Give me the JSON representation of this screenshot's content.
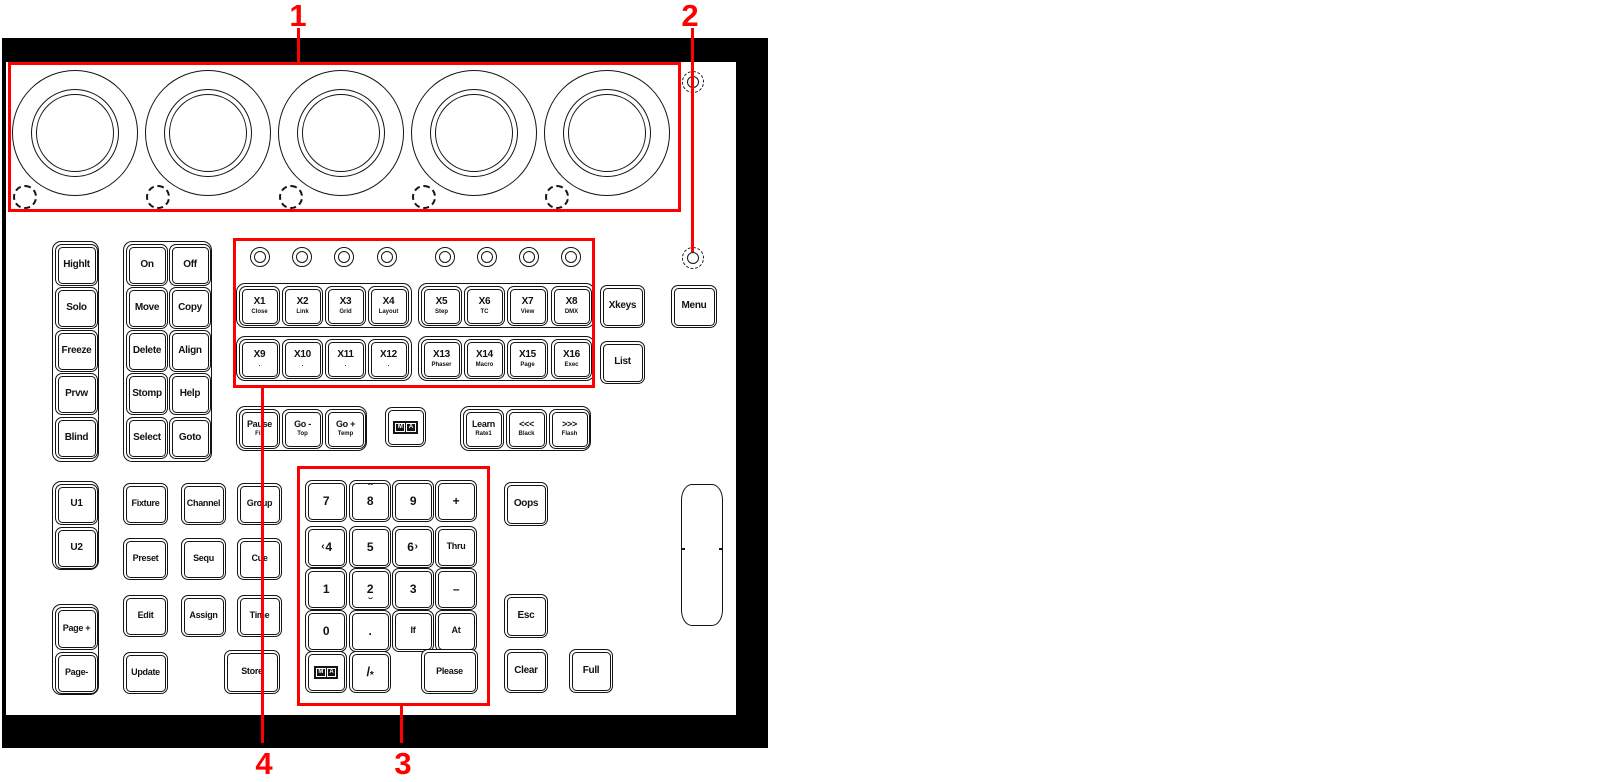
{
  "annotations": {
    "n1": "1",
    "n2": "2",
    "n3": "3",
    "n4": "4"
  },
  "colors": {
    "annotation_red": "#ff0000",
    "line_art": "#141414",
    "frame": "#000000"
  },
  "left_strip": [
    "Highlt",
    "Solo",
    "Freeze",
    "Prvw",
    "Blind"
  ],
  "action": [
    "On",
    "Off",
    "Move",
    "Copy",
    "Delete",
    "Align",
    "Stomp",
    "Help",
    "Select",
    "Goto"
  ],
  "user": {
    "u1": "U1",
    "u2": "U2",
    "page_up": "Page +",
    "page_down": "Page-"
  },
  "grid": {
    "fixture": "Fixture",
    "channel": "Channel",
    "group": "Group",
    "preset": "Preset",
    "sequ": "Sequ",
    "cue": "Cue",
    "edit": "Edit",
    "assign": "Assign",
    "time": "Time",
    "update": "Update",
    "store": "Store"
  },
  "command": {
    "xkeys": "Xkeys",
    "list": "List",
    "menu": "Menu",
    "oops": "Oops",
    "esc": "Esc",
    "clear": "Clear",
    "full": "Full"
  },
  "xkeys": {
    "x1": {
      "m": "X1",
      "s": "Close"
    },
    "x2": {
      "m": "X2",
      "s": "Link"
    },
    "x3": {
      "m": "X3",
      "s": "Grid"
    },
    "x4": {
      "m": "X4",
      "s": "Layout"
    },
    "x5": {
      "m": "X5",
      "s": "Step"
    },
    "x6": {
      "m": "X6",
      "s": "TC"
    },
    "x7": {
      "m": "X7",
      "s": "View"
    },
    "x8": {
      "m": "X8",
      "s": "DMX"
    },
    "x9": {
      "m": "X9",
      "s": "."
    },
    "x10": {
      "m": "X10",
      "s": "."
    },
    "x11": {
      "m": "X11",
      "s": "."
    },
    "x12": {
      "m": "X12",
      "s": "."
    },
    "x13": {
      "m": "X13",
      "s": "Phaser"
    },
    "x14": {
      "m": "X14",
      "s": "Macro"
    },
    "x15": {
      "m": "X15",
      "s": "Page"
    },
    "x16": {
      "m": "X16",
      "s": "Exec"
    }
  },
  "playback": {
    "pause": {
      "m": "Pause",
      "s": "Fix"
    },
    "go_minus": {
      "m": "Go -",
      "s": "Top"
    },
    "go_plus": {
      "m": "Go +",
      "s": "Temp"
    },
    "learn": {
      "m": "Learn",
      "s": "Rate1"
    },
    "back": {
      "m": "<<<",
      "s": "Black"
    },
    "fwd": {
      "m": ">>>",
      "s": "Flash"
    }
  },
  "ma": {
    "m": "M",
    "a": "A"
  },
  "keypad": {
    "r1": [
      "7",
      "8",
      "9",
      "+"
    ],
    "r2": [
      "4",
      "5",
      "6",
      "Thru"
    ],
    "r3": [
      "1",
      "2",
      "3",
      "–"
    ],
    "r4": [
      "0",
      ".",
      "If",
      "At"
    ],
    "r5": {
      "slash": "/",
      "star": "*",
      "please": "Please"
    },
    "arrows": {
      "up": "ˆ",
      "down": "ˇ",
      "left": "‹",
      "right": "›"
    }
  }
}
